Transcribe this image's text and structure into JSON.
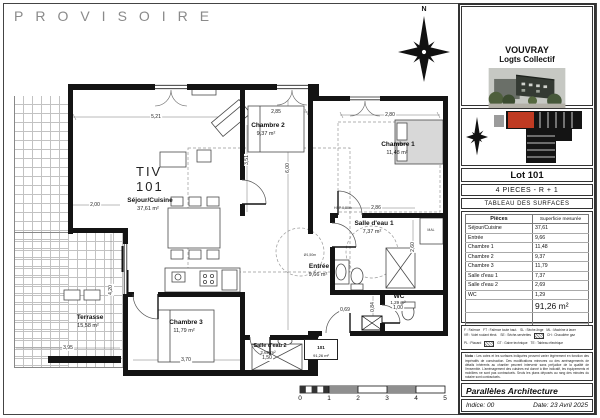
{
  "watermark": "PROVISOIRE",
  "plan": {
    "unit": {
      "type": "TIV",
      "number": "101"
    },
    "north_label": "N",
    "rooms": [
      {
        "name": "Séjour/Cuisine",
        "area": "37,61 m²"
      },
      {
        "name": "Chambre 2",
        "area": "9,37 m²"
      },
      {
        "name": "Chambre 1",
        "area": "11,48 m²"
      },
      {
        "name": "Salle d'eau 1",
        "area": "7,37 m²"
      },
      {
        "name": "Entrée",
        "area": "9,66 m²"
      },
      {
        "name": "Chambre 3",
        "area": "11,79 m²"
      },
      {
        "name": "Salle d'eau 2",
        "area": "2,69 m²"
      },
      {
        "name": "WC",
        "area": "1,29 m²"
      },
      {
        "name": "Terrasse",
        "area": "15,58 m²"
      }
    ],
    "dimensions": {
      "sejour_w": "5,21",
      "ch2_w": "2,85",
      "ch1_w": "2,80",
      "sejour_h": "6,00",
      "ch2_h": "3,51",
      "sde1_w": "2,86",
      "sde1_h": "2,60",
      "ch3_w": "3,70",
      "terrasse_w": "3,95",
      "terrasse_h": "4,20",
      "balcon": "2,00",
      "wc_h": "0,84",
      "hall_w": "0,69",
      "sde2_w": "1,50",
      "wc_w": "1,00"
    },
    "annotations": {
      "hsp": "HSP 0,80m",
      "circle": "Ø1,50m",
      "closet": "MAL"
    },
    "door_tag": {
      "lot": "101",
      "area": "91,26 m²"
    },
    "scale": {
      "ticks": [
        "0",
        "1",
        "2",
        "3",
        "4",
        "5"
      ]
    }
  },
  "titleblock": {
    "project": "VOUVRAY",
    "subtitle": "Logts Collectif",
    "lot": "Lot 101",
    "type": "4 PIECES - R + 1",
    "table_title": "TABLEAU DES SURFACES",
    "table": {
      "headers": [
        "Pièces",
        "Superficie mesurée"
      ],
      "rows": [
        [
          "Séjour/Cuisine",
          "37,61"
        ],
        [
          "Entrée",
          "9,66"
        ],
        [
          "Chambre 1",
          "11,48"
        ],
        [
          "Chambre 2",
          "9,37"
        ],
        [
          "Chambre 3",
          "11,79"
        ],
        [
          "Salle d'eau 1",
          "7,37"
        ],
        [
          "Salle d'eau 2",
          "2,69"
        ],
        [
          "WC",
          "1,29"
        ]
      ],
      "total": "91,26 m²",
      "terrasse": [
        "Terrasse",
        "15,58"
      ]
    },
    "legend": {
      "items": [
        "F : Faïence",
        "FT : Faïence toute haut.",
        "SL : Sèche-linge",
        "ML : Machine à laver",
        "VR : Volet roulant élect.",
        "SE : Sèche-serviettes",
        "CH : Chaudière gaz",
        "PL : Placard",
        "GT : Gaine technique",
        "TE : Tableau électrique"
      ]
    },
    "nota_label": "Nota :",
    "nota_text": "Les cotes et les surfaces indiquées peuvent varier légèrement en fonction des impératifs de construction. Des modifications mineures ou des aménagements de détails inhérents au chantier peuvent intervenir sans préjudice de la qualité de l'ensemble. L'aménagement des cuisines est donné à titre indicatif, les équipements et mobiliers ne sont pas contractuels. Seuls les plans déposés au rang des minutes du notaire sont contractuels.",
    "firm": "Parallèles Architecture",
    "indice": "Indice: 00",
    "date": "Date: 23 Avril 2025"
  }
}
